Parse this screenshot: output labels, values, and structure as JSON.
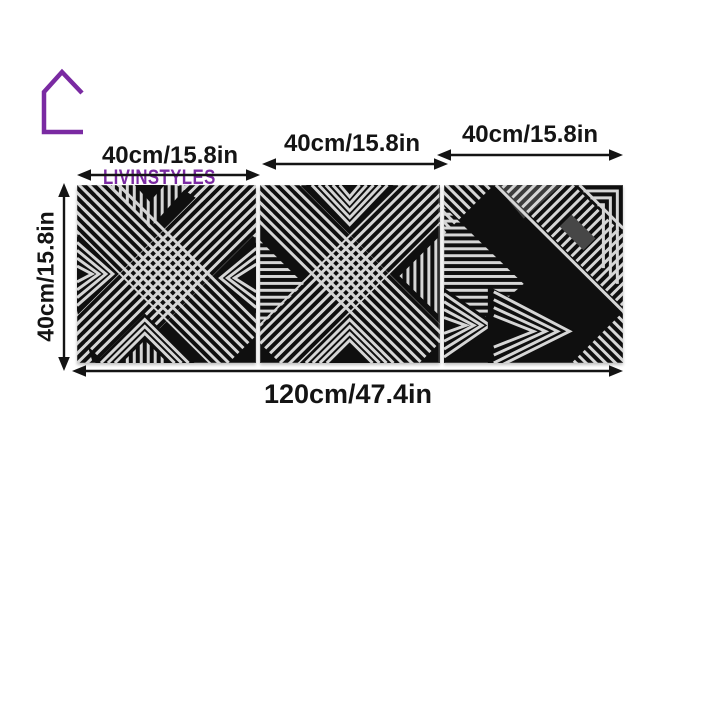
{
  "brand": {
    "name": "LIVINSTYLES",
    "logo_icon": "house-outline-icon",
    "color": "#7A2AA2"
  },
  "dimensions": {
    "panel_width_labels": [
      "40cm/15.8in",
      "40cm/15.8in",
      "40cm/15.8in"
    ],
    "panel_height_label": "40cm/15.8in",
    "total_width_label": "120cm/47.4in"
  },
  "panels": {
    "count": 3,
    "description": "black metal panels with geometric line art",
    "background_color": "#0f0f0f",
    "stripe_color": "#d6d6d6"
  },
  "annotation_color": "#141414"
}
